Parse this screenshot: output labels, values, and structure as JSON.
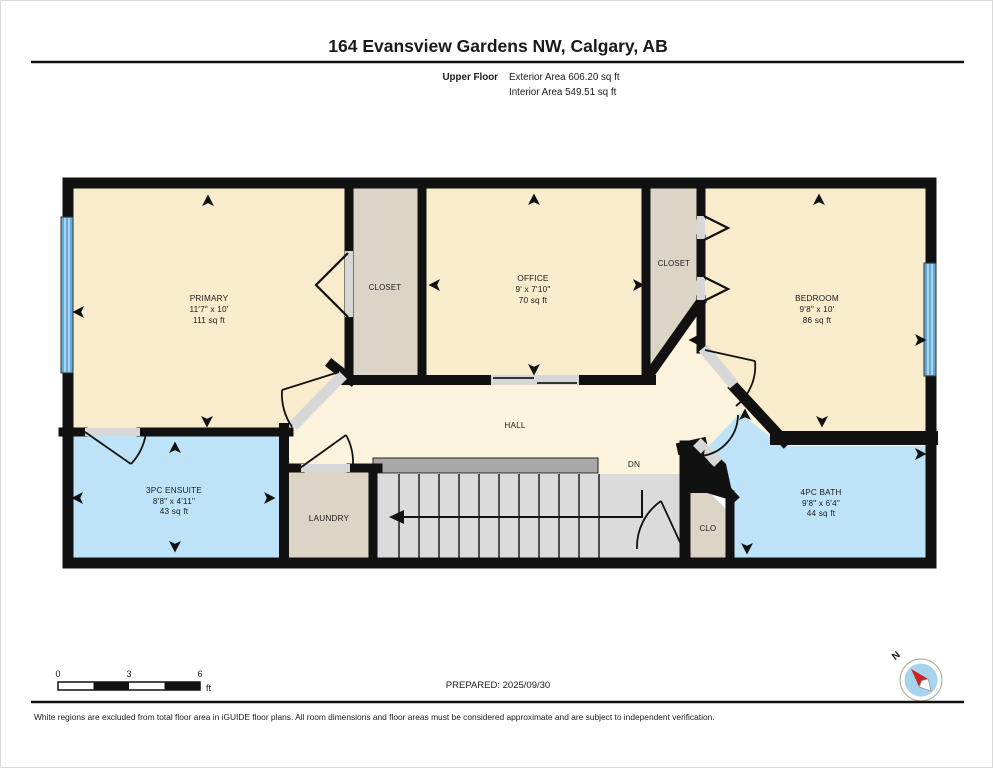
{
  "header": {
    "title": "164 Evansview Gardens NW, Calgary, AB",
    "floor_label": "Upper Floor",
    "exterior_area": "Exterior Area 606.20 sq ft",
    "interior_area": "Interior Area 549.51 sq ft"
  },
  "rooms": {
    "primary": {
      "name": "PRIMARY",
      "dims": "11'7\" x 10'",
      "area": "111 sq ft"
    },
    "closet_left": {
      "name": "CLOSET"
    },
    "office": {
      "name": "OFFICE",
      "dims": "9' x 7'10\"",
      "area": "70 sq ft"
    },
    "closet_right": {
      "name": "CLOSET"
    },
    "bedroom": {
      "name": "BEDROOM",
      "dims": "9'8\" x 10'",
      "area": "86 sq ft"
    },
    "hall": {
      "name": "HALL"
    },
    "ensuite": {
      "name": "3PC ENSUITE",
      "dims": "8'8\" x 4'11\"",
      "area": "43 sq ft"
    },
    "laundry": {
      "name": "LAUNDRY"
    },
    "bath": {
      "name": "4PC BATH",
      "dims": "9'8\" x 6'4\"",
      "area": "44 sq ft"
    },
    "clo": {
      "name": "CLO"
    },
    "stairs": {
      "label": "DN"
    }
  },
  "scale_bar": {
    "t0": "0",
    "t3": "3",
    "t6": "6",
    "unit": "ft"
  },
  "footer": {
    "prepared": "PREPARED: 2025/09/30",
    "compass_n": "N",
    "disclaimer": "White regions are excluded from total floor area in iGUIDE floor plans. All room dimensions and floor areas must be considered approximate and are subject to independent verification."
  },
  "colors": {
    "room": "#F8ECCD",
    "hall": "#FBF3DB",
    "closet": "#DCD4C5",
    "bath": "#BEE3F8",
    "window": "#64AAD9",
    "wall": "#111111",
    "stairs": "#DBDBDB",
    "stair_bar": "#A9A9A9",
    "door_opening": "#D7D7D7"
  }
}
